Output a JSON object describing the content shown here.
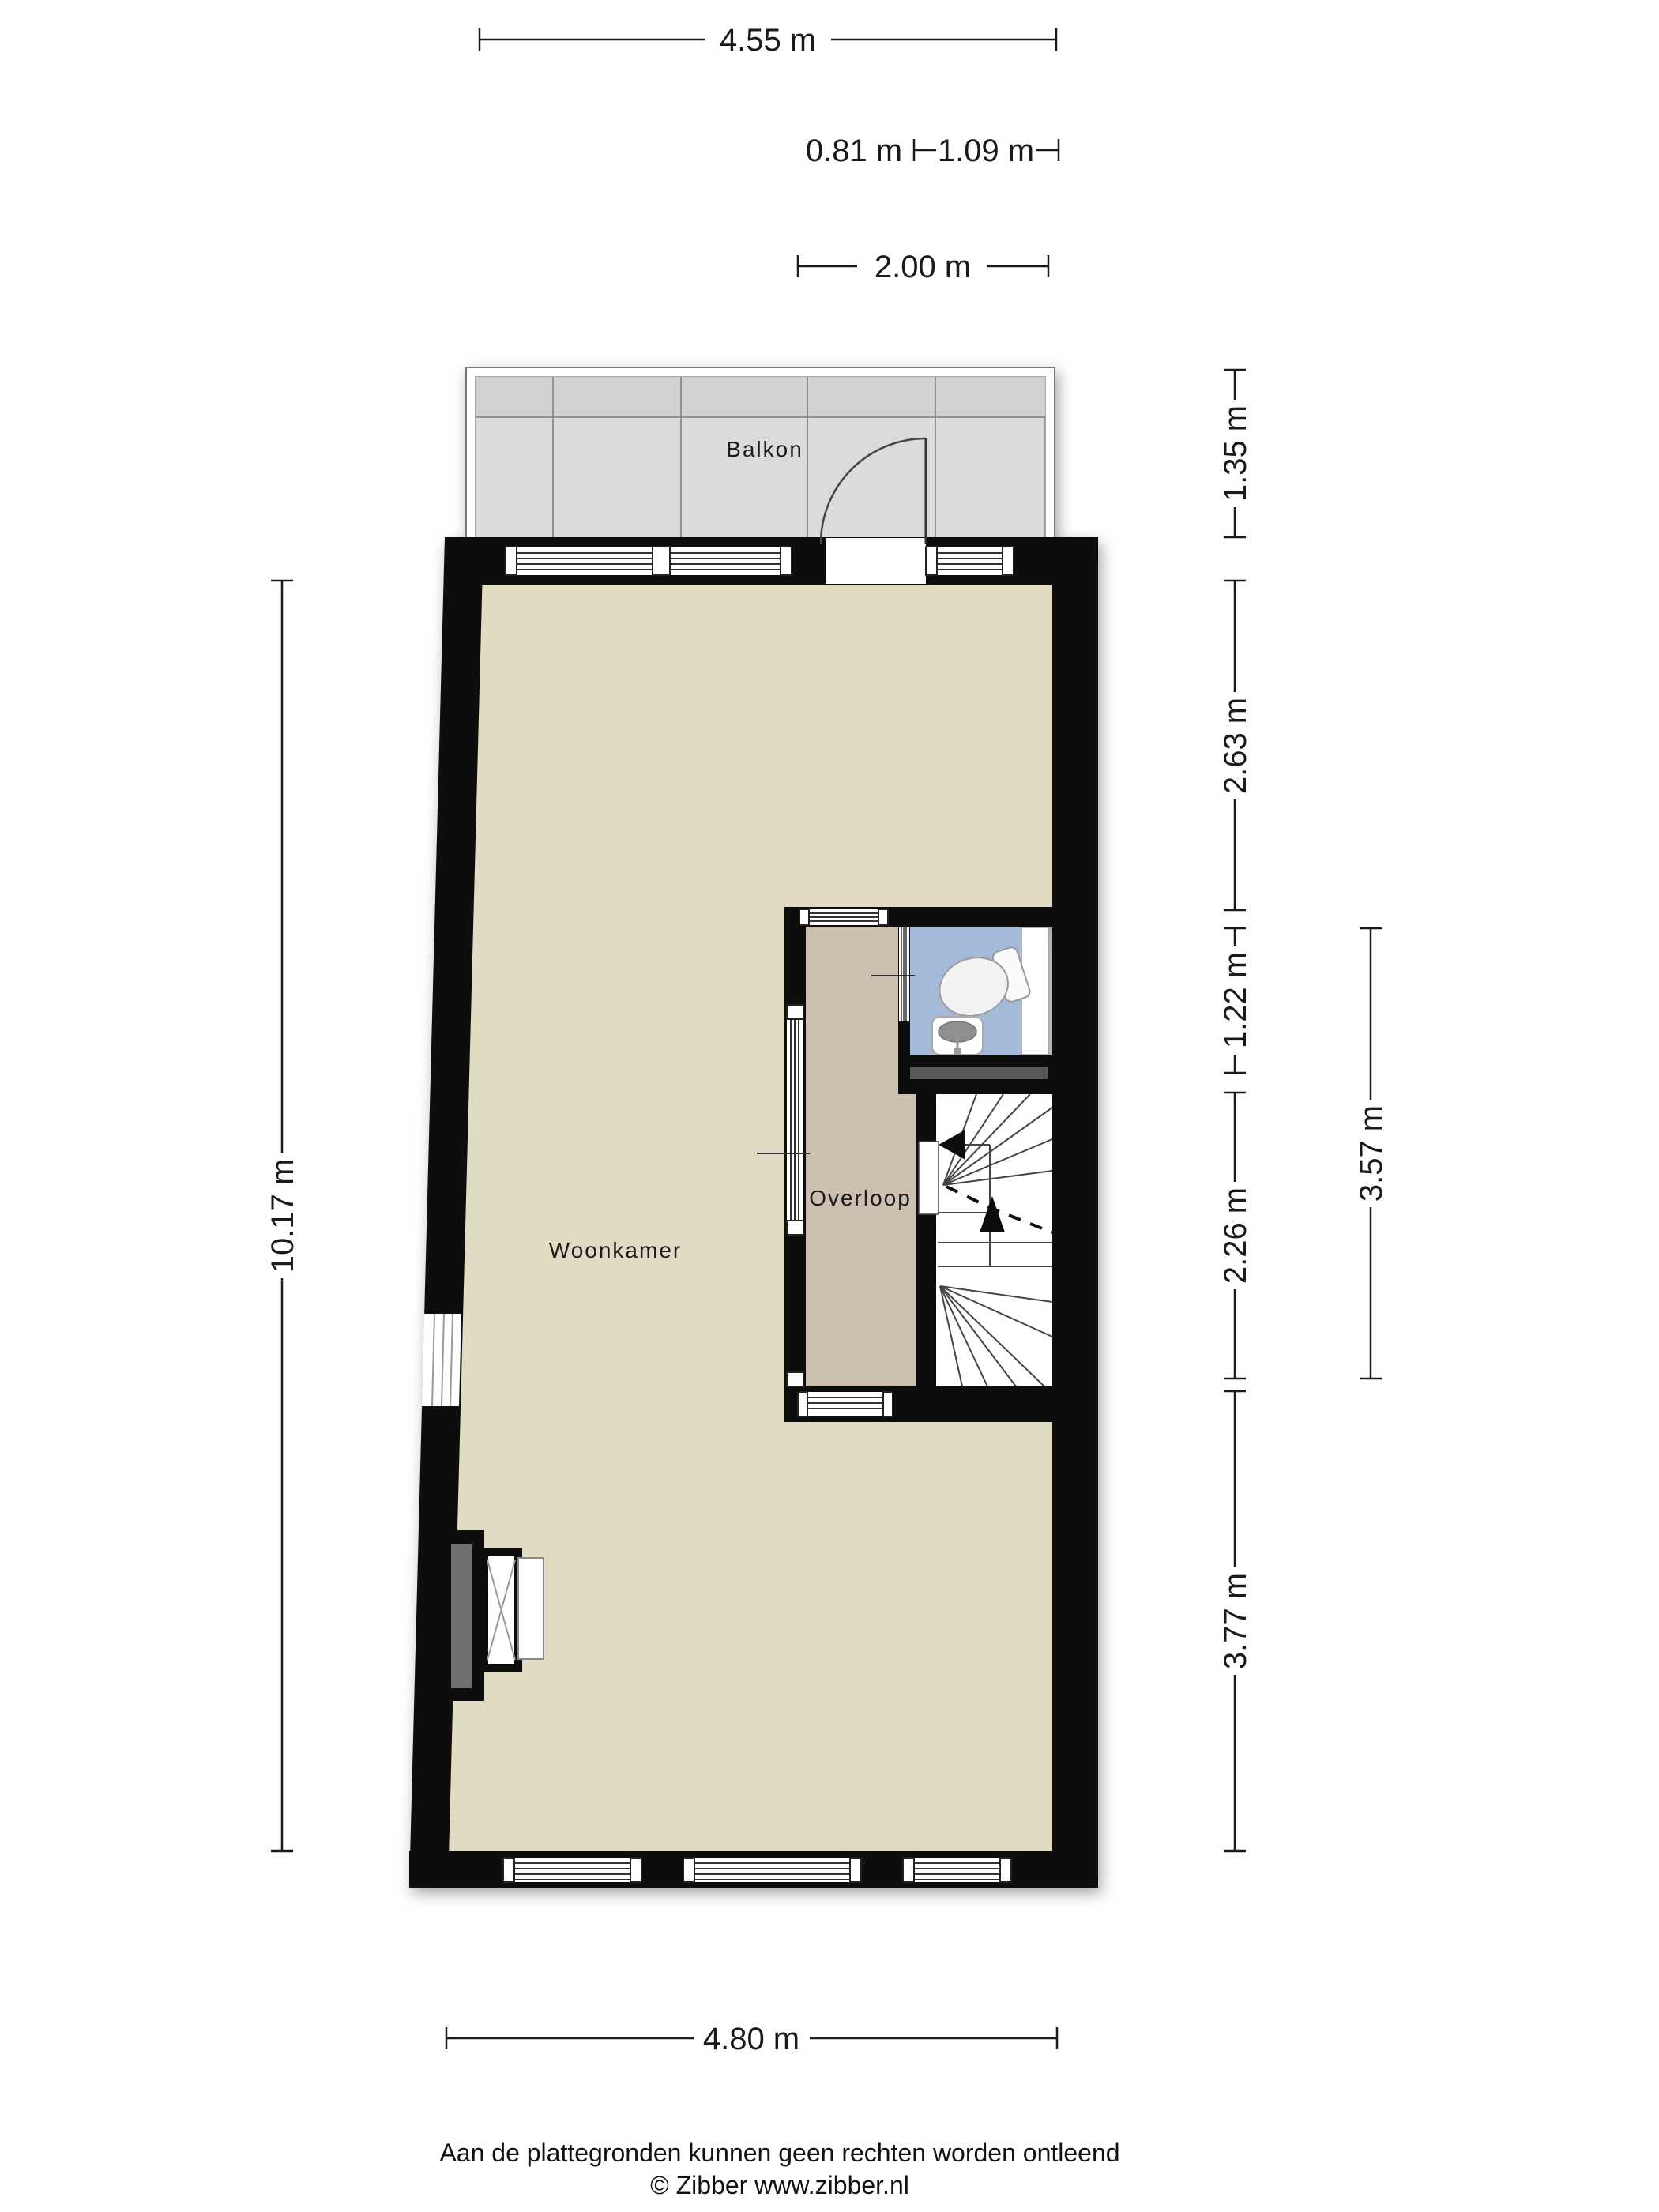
{
  "rooms": {
    "balcony": "Balkon",
    "living": "Woonkamer",
    "landing": "Overloop"
  },
  "dimensions": {
    "top_total": "4.55 m",
    "door": "0.81 m",
    "window": "1.09 m",
    "balcony_width": "2.00 m",
    "balcony_depth": "1.35 m",
    "living_upper": "2.63 m",
    "toilet": "1.22 m",
    "stairs": "2.26 m",
    "living_lower": "3.77 m",
    "block": "3.57 m",
    "left_total": "10.17 m",
    "bottom_total": "4.80 m"
  },
  "footer": {
    "disclaimer": "Aan de plattegronden kunnen geen rechten worden ontleend",
    "credit": "© Zibber www.zibber.nl"
  },
  "colors": {
    "wall": "#0b0b0b",
    "floor-living": "#e2dbc4",
    "floor-landing": "#ccc0b0",
    "floor-toilet": "#a5bad8",
    "floor-balcony": "#dbdbdb",
    "balcony-upper": "#d2d2d2",
    "wall-accent": "#585858",
    "chimney-gray": "#6f6f6f",
    "line": "#1a1a1a"
  }
}
